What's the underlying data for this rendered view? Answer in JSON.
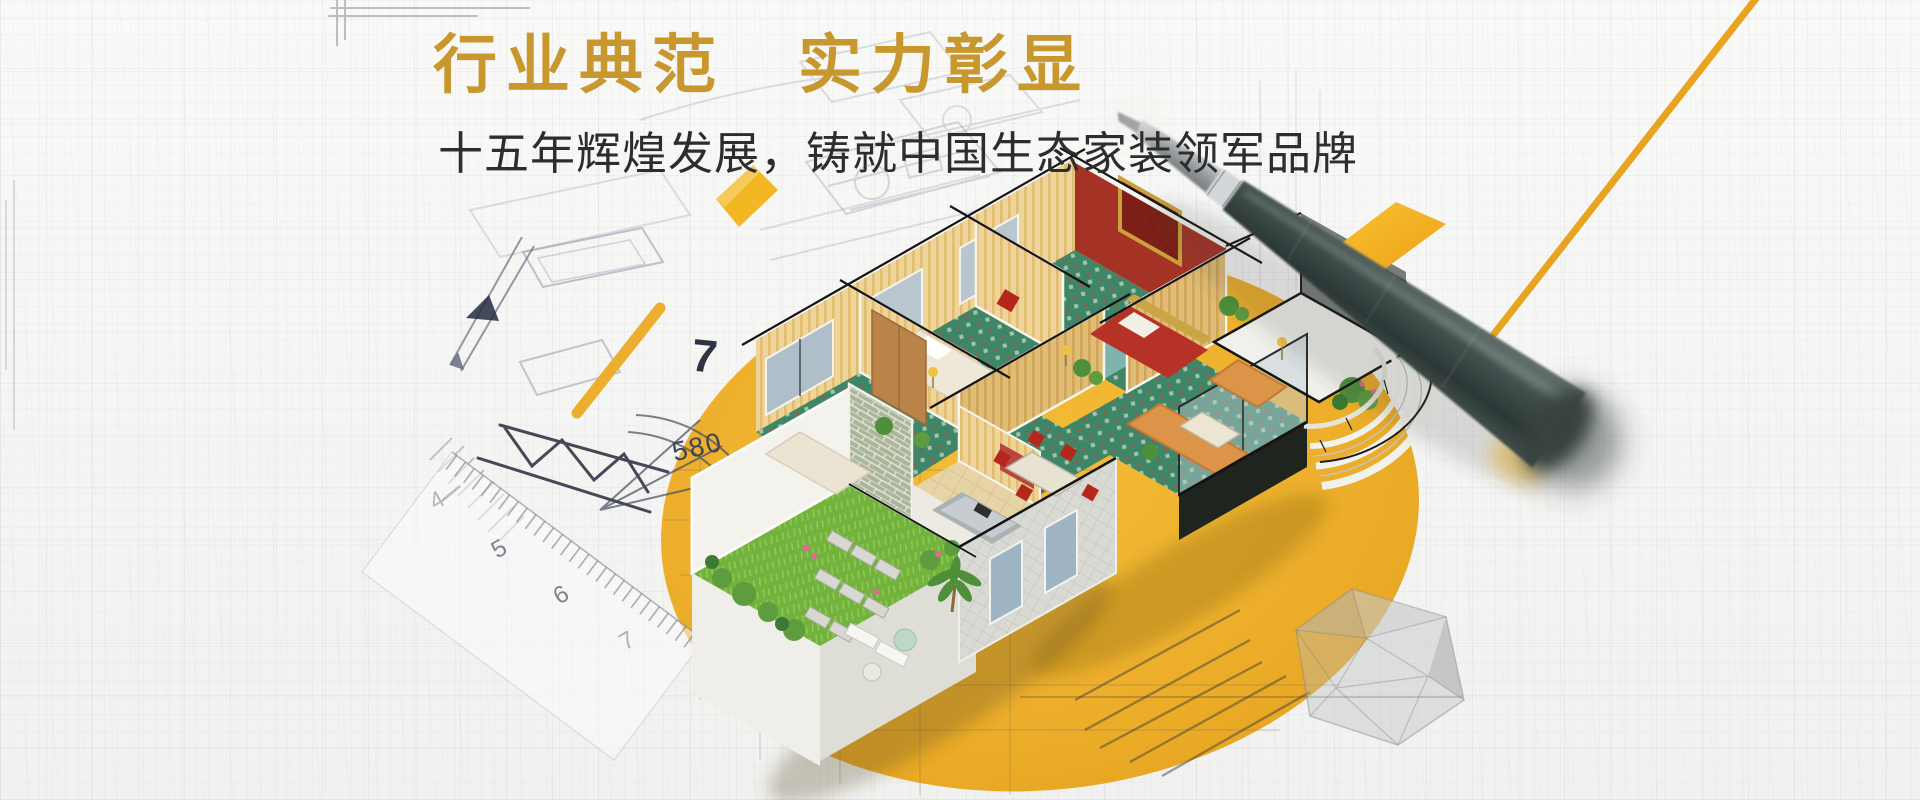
{
  "banner": {
    "title": "行业典范　实力彰显",
    "subtitle": "十五年辉煌发展，铸就中国生态家装领军品牌"
  },
  "blueprint": {
    "sketch_number": "7",
    "dimension_label": "580",
    "ruler_numbers": [
      "4",
      "5",
      "6",
      "7"
    ]
  },
  "palette": {
    "title_gold": "#c8982e",
    "subtitle_dark": "#2d2d2d",
    "ellipse_yellow": "#edb02f",
    "accent_orange_line": "#e8a31f",
    "diamond_yellow": "#f3ab1e",
    "pen_body": "#3d4b49",
    "carpet_green": "#3f8668",
    "grass_green": "#72b23d",
    "brick_green": "#aab79c",
    "sofa_orange": "#db9448",
    "paper": "#f6f6f4"
  }
}
